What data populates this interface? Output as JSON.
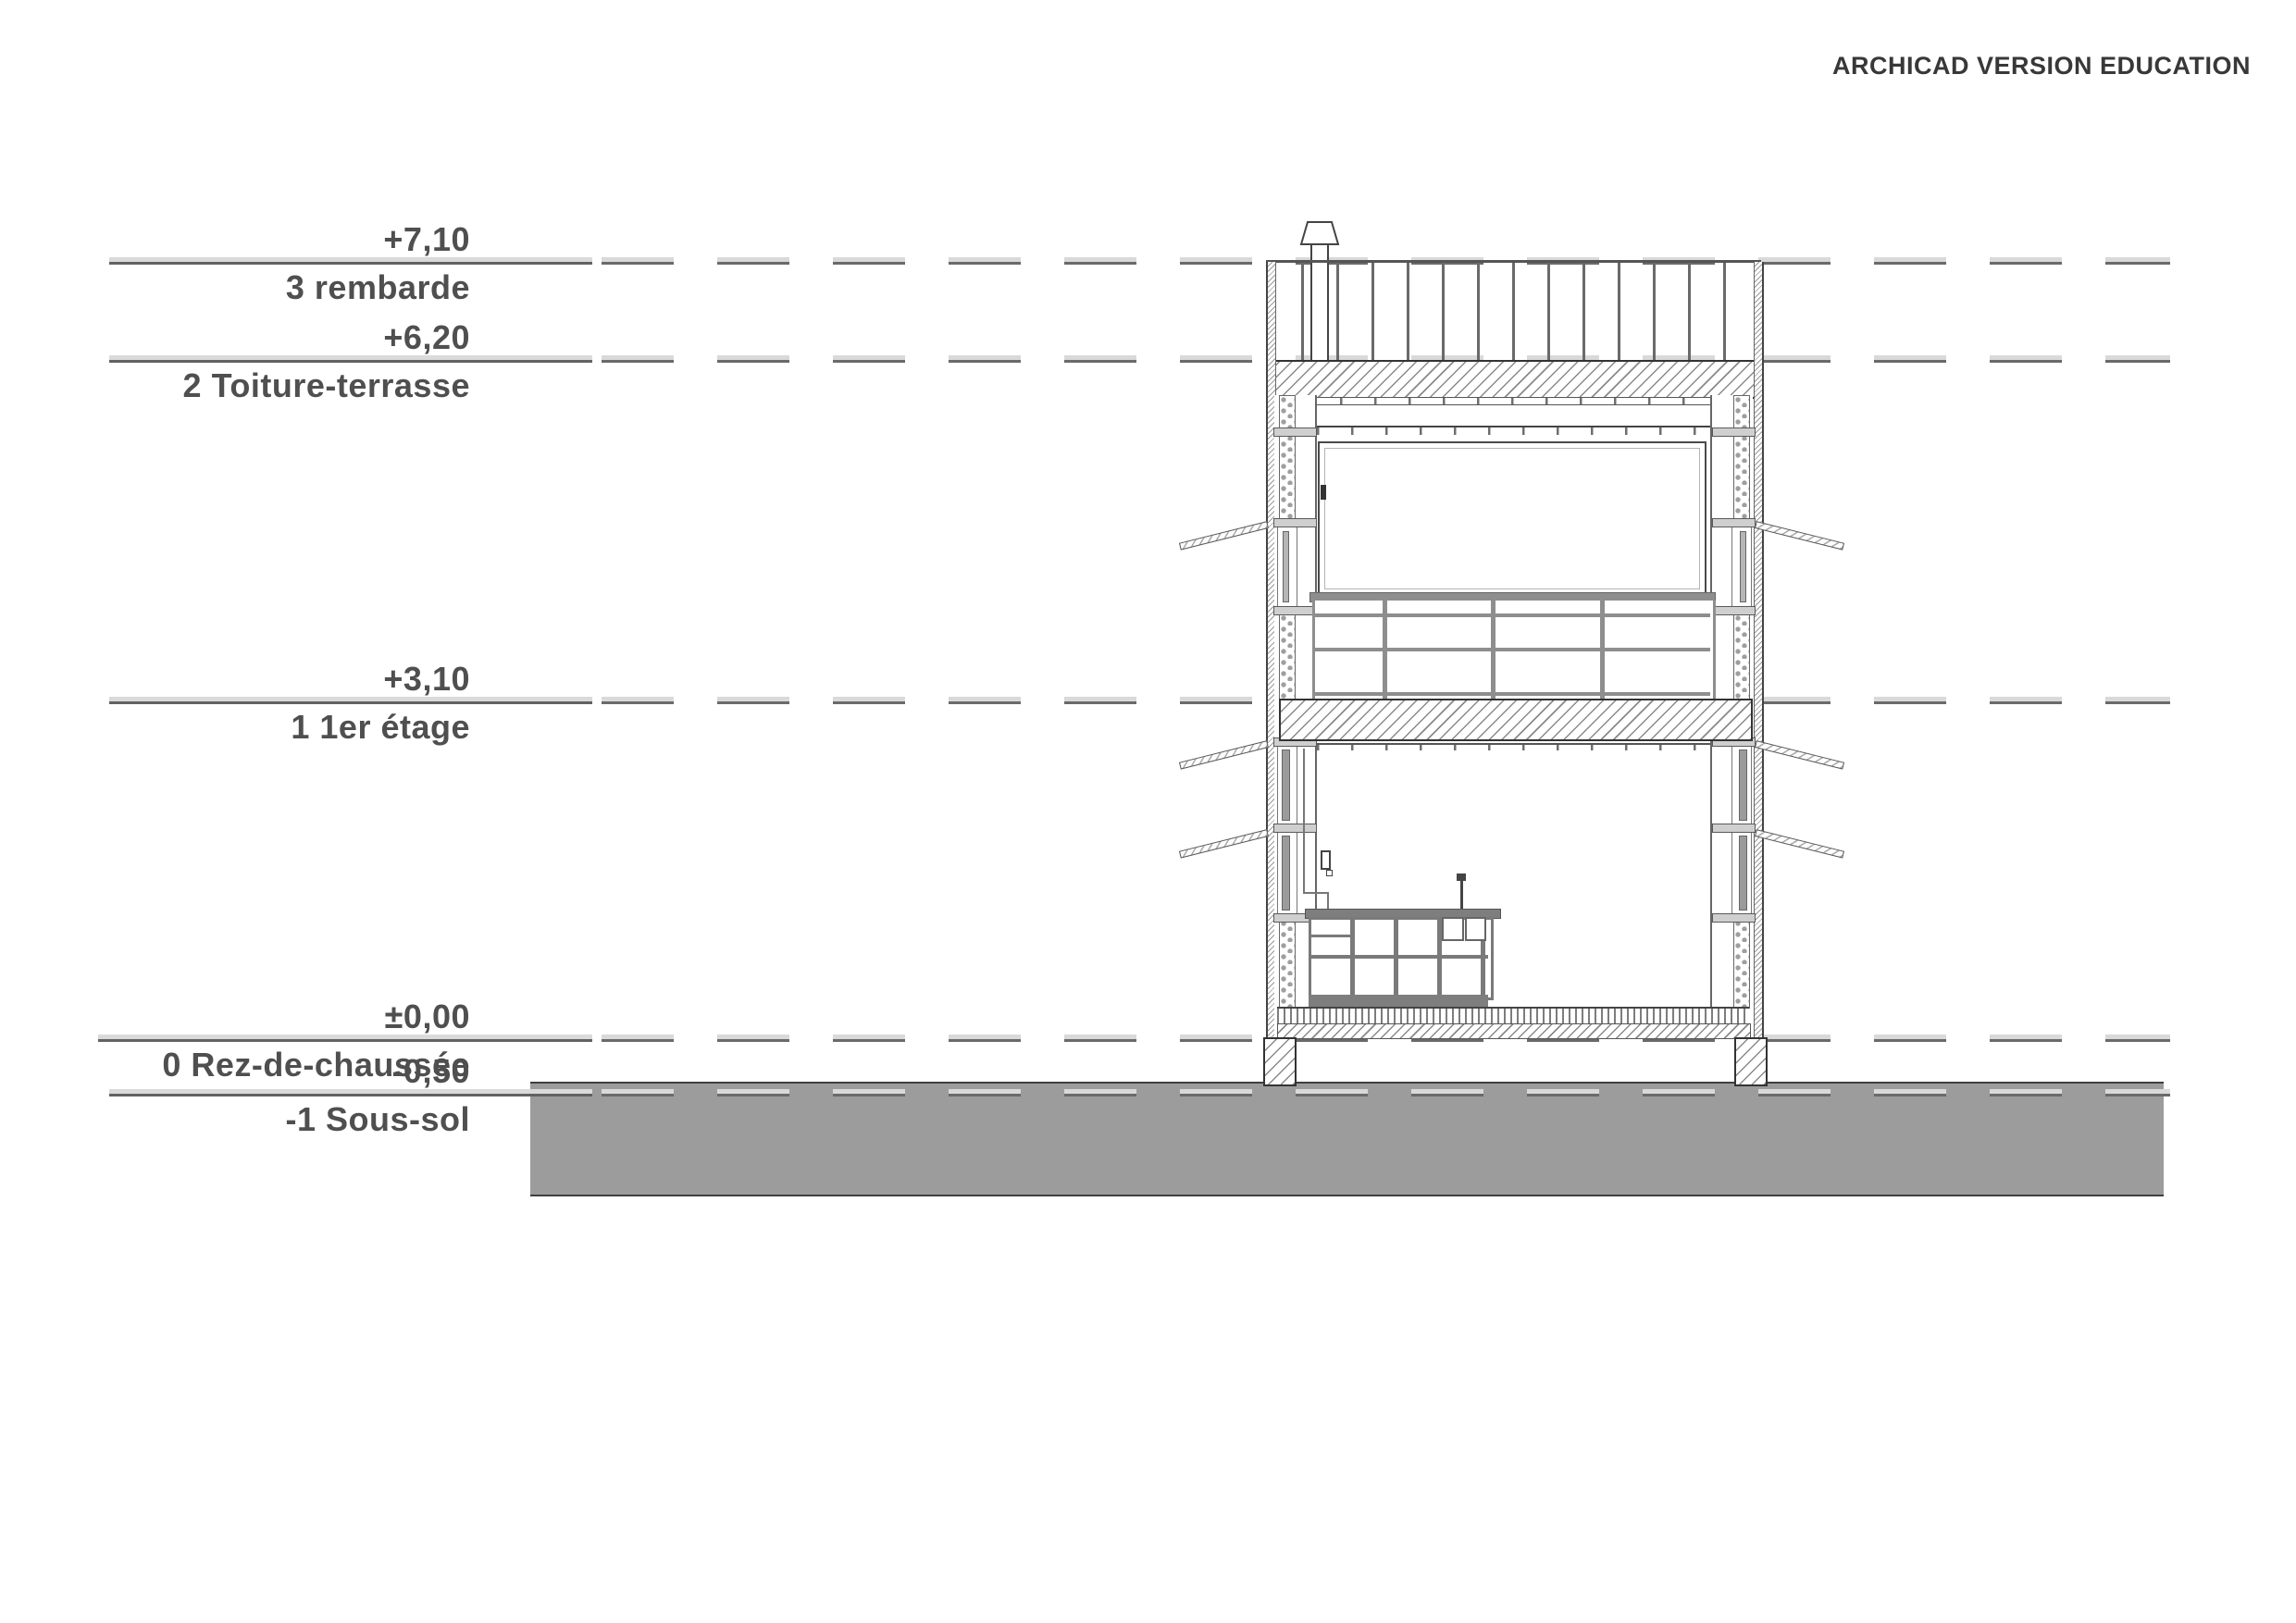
{
  "watermark": "ARCHICAD VERSION EDUCATION",
  "levels": [
    {
      "value": "+7,10",
      "name": "3 rembarde"
    },
    {
      "value": "+6,20",
      "name": "2 Toiture-terrasse"
    },
    {
      "value": "+3,10",
      "name": "1 1er étage"
    },
    {
      "value": "±0,00",
      "name": "0 Rez-de-chaussée"
    },
    {
      "value": "-0,50",
      "name": "-1 Sous-sol"
    }
  ],
  "colors": {
    "ground_fill": "#9c9c9c",
    "level_line_dark": "#6a6a6a",
    "level_line_light": "#d9d9d9",
    "label_text": "#4f4f4f",
    "watermark_text": "#383838"
  }
}
